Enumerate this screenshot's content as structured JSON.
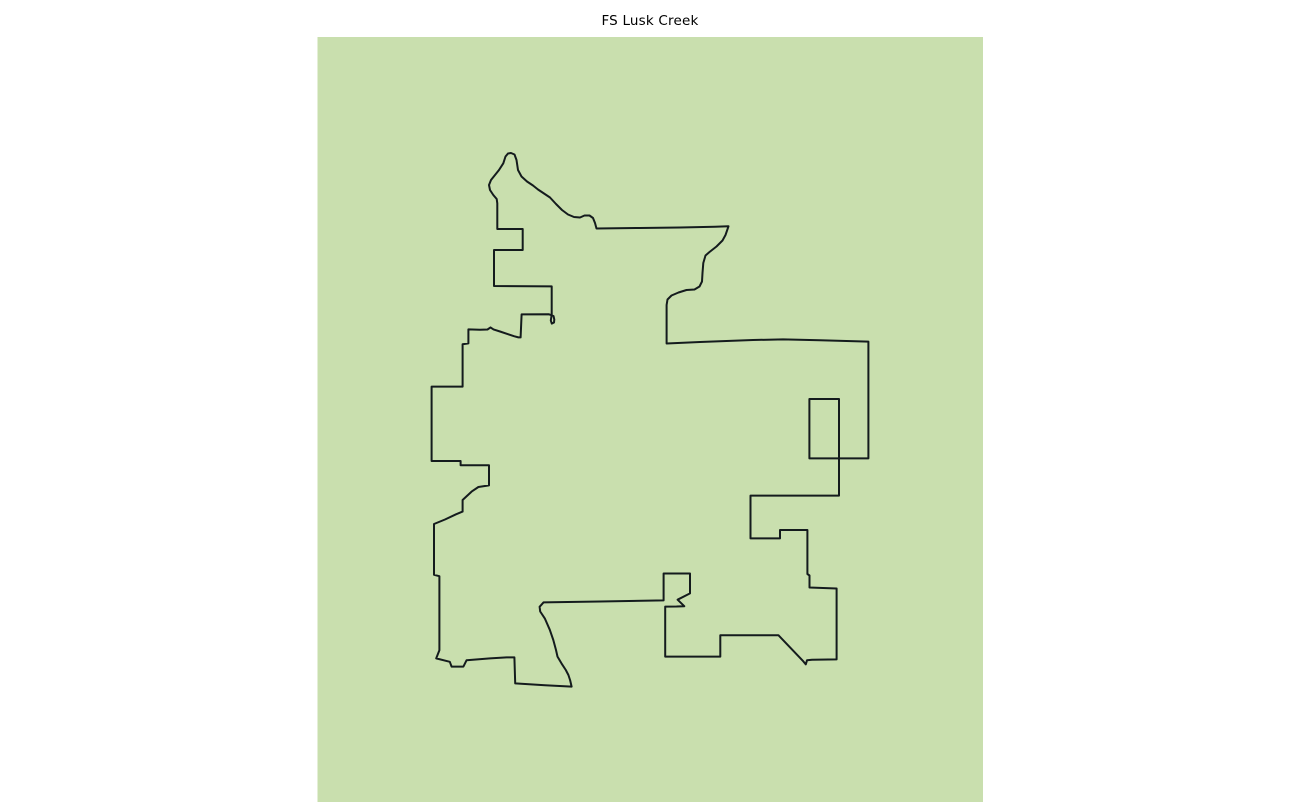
{
  "title": "FS Lusk Creek",
  "figure": {
    "width": 1300,
    "height": 802,
    "background_color": "#ffffff",
    "title_color": "#000000"
  },
  "map": {
    "name": "FS Lusk Creek boundary",
    "background_color": "#c9dfae",
    "outline_color": "#141b1d",
    "outline_width": 2,
    "axes_rect": {
      "x": 317.5,
      "y": 37,
      "width": 665.5,
      "height": 765
    },
    "boundary_points": [
      [
        505.5,
        156.5
      ],
      [
        508,
        153.5
      ],
      [
        511,
        153
      ],
      [
        514.5,
        154.5
      ],
      [
        516.5,
        160
      ],
      [
        518,
        170
      ],
      [
        521.5,
        176.5
      ],
      [
        527,
        181.5
      ],
      [
        533,
        185.5
      ],
      [
        538,
        189.5
      ],
      [
        544,
        193.5
      ],
      [
        550,
        197.5
      ],
      [
        556,
        204
      ],
      [
        562,
        210
      ],
      [
        568,
        214.5
      ],
      [
        574,
        217
      ],
      [
        580,
        217.5
      ],
      [
        584.5,
        215.5
      ],
      [
        589.5,
        215.5
      ],
      [
        593,
        218
      ],
      [
        595,
        223
      ],
      [
        596.5,
        228.5
      ],
      [
        640,
        228
      ],
      [
        680,
        227.5
      ],
      [
        715,
        226.8
      ],
      [
        728.5,
        226.3
      ],
      [
        725.5,
        235
      ],
      [
        722.5,
        240.5
      ],
      [
        716.5,
        246.5
      ],
      [
        709.5,
        252
      ],
      [
        705.5,
        255.5
      ],
      [
        703.3,
        263
      ],
      [
        702.5,
        273
      ],
      [
        702,
        281.5
      ],
      [
        699.5,
        286.5
      ],
      [
        694.5,
        289.5
      ],
      [
        686.5,
        290
      ],
      [
        678.5,
        292.5
      ],
      [
        671.5,
        295.5
      ],
      [
        667.5,
        299.5
      ],
      [
        666.6,
        305
      ],
      [
        666.6,
        343.5
      ],
      [
        700,
        342
      ],
      [
        753,
        340
      ],
      [
        783,
        339.4
      ],
      [
        820,
        340.3
      ],
      [
        868.4,
        341.6
      ],
      [
        868.4,
        458.4
      ],
      [
        809.4,
        458.4
      ],
      [
        809.4,
        399
      ],
      [
        839,
        399
      ],
      [
        839,
        495.6
      ],
      [
        750.5,
        495.6
      ],
      [
        750.5,
        538.4
      ],
      [
        780,
        538.4
      ],
      [
        780,
        530
      ],
      [
        807.4,
        530
      ],
      [
        807.4,
        574
      ],
      [
        809.5,
        575.5
      ],
      [
        809.5,
        587.5
      ],
      [
        836.6,
        588.5
      ],
      [
        836.6,
        659.4
      ],
      [
        812,
        659.8
      ],
      [
        807,
        660.3
      ],
      [
        805.8,
        664.4
      ],
      [
        803.2,
        661.2
      ],
      [
        778.4,
        635.2
      ],
      [
        720.3,
        635.2
      ],
      [
        720.3,
        656.6
      ],
      [
        665.2,
        656.6
      ],
      [
        665.2,
        606.6
      ],
      [
        676.5,
        606.5
      ],
      [
        684.3,
        606.2
      ],
      [
        677.6,
        599.7
      ],
      [
        690,
        593.4
      ],
      [
        690,
        573.5
      ],
      [
        663.6,
        573.5
      ],
      [
        663.6,
        600.4
      ],
      [
        600,
        601.5
      ],
      [
        543.5,
        602.4
      ],
      [
        539.6,
        606.8
      ],
      [
        540.2,
        611.5
      ],
      [
        544.8,
        618.4
      ],
      [
        549.8,
        629.8
      ],
      [
        553.3,
        640
      ],
      [
        556,
        650
      ],
      [
        557.5,
        656.6
      ],
      [
        561.5,
        663.4
      ],
      [
        565.8,
        670
      ],
      [
        568.4,
        675
      ],
      [
        570.2,
        680.5
      ],
      [
        571.6,
        686.6
      ],
      [
        545,
        685.2
      ],
      [
        515.2,
        683.4
      ],
      [
        514.4,
        657.4
      ],
      [
        506.6,
        657.4
      ],
      [
        490,
        658.4
      ],
      [
        466.6,
        660.2
      ],
      [
        463.4,
        666.6
      ],
      [
        451.6,
        666.6
      ],
      [
        449.8,
        661.8
      ],
      [
        436.2,
        658.4
      ],
      [
        439.4,
        650.2
      ],
      [
        439.4,
        576.2
      ],
      [
        434,
        574.8
      ],
      [
        434,
        524
      ],
      [
        445,
        519.5
      ],
      [
        456,
        514.3
      ],
      [
        462.6,
        511.6
      ],
      [
        462.6,
        500
      ],
      [
        471.6,
        491.6
      ],
      [
        478.4,
        487
      ],
      [
        489,
        485.4
      ],
      [
        489,
        465.2
      ],
      [
        460.6,
        465.2
      ],
      [
        460.6,
        461
      ],
      [
        431.6,
        461
      ],
      [
        431.6,
        386.6
      ],
      [
        462.6,
        386.6
      ],
      [
        462.6,
        344.2
      ],
      [
        468.4,
        343.4
      ],
      [
        468.4,
        329.4
      ],
      [
        480,
        329.8
      ],
      [
        487.5,
        329.5
      ],
      [
        490.5,
        327.4
      ],
      [
        493.5,
        329.4
      ],
      [
        500,
        331.5
      ],
      [
        508,
        334.2
      ],
      [
        514,
        336.2
      ],
      [
        518.4,
        337.4
      ],
      [
        520.6,
        337.4
      ],
      [
        521.6,
        314.4
      ],
      [
        549,
        314.3
      ],
      [
        553.5,
        316
      ],
      [
        554.3,
        319.5
      ],
      [
        554,
        322.5
      ],
      [
        551.8,
        323.6
      ],
      [
        550.8,
        320.5
      ],
      [
        551.7,
        314.5
      ],
      [
        551.7,
        286.4
      ],
      [
        494,
        286
      ],
      [
        494,
        250
      ],
      [
        522.7,
        250
      ],
      [
        522.7,
        229
      ],
      [
        497.3,
        229
      ],
      [
        497.3,
        203.3
      ],
      [
        496.7,
        199
      ],
      [
        493.3,
        195
      ],
      [
        490,
        190
      ],
      [
        489,
        185
      ],
      [
        491,
        180
      ],
      [
        495,
        175
      ],
      [
        499,
        170
      ],
      [
        503.3,
        163.3
      ]
    ]
  }
}
